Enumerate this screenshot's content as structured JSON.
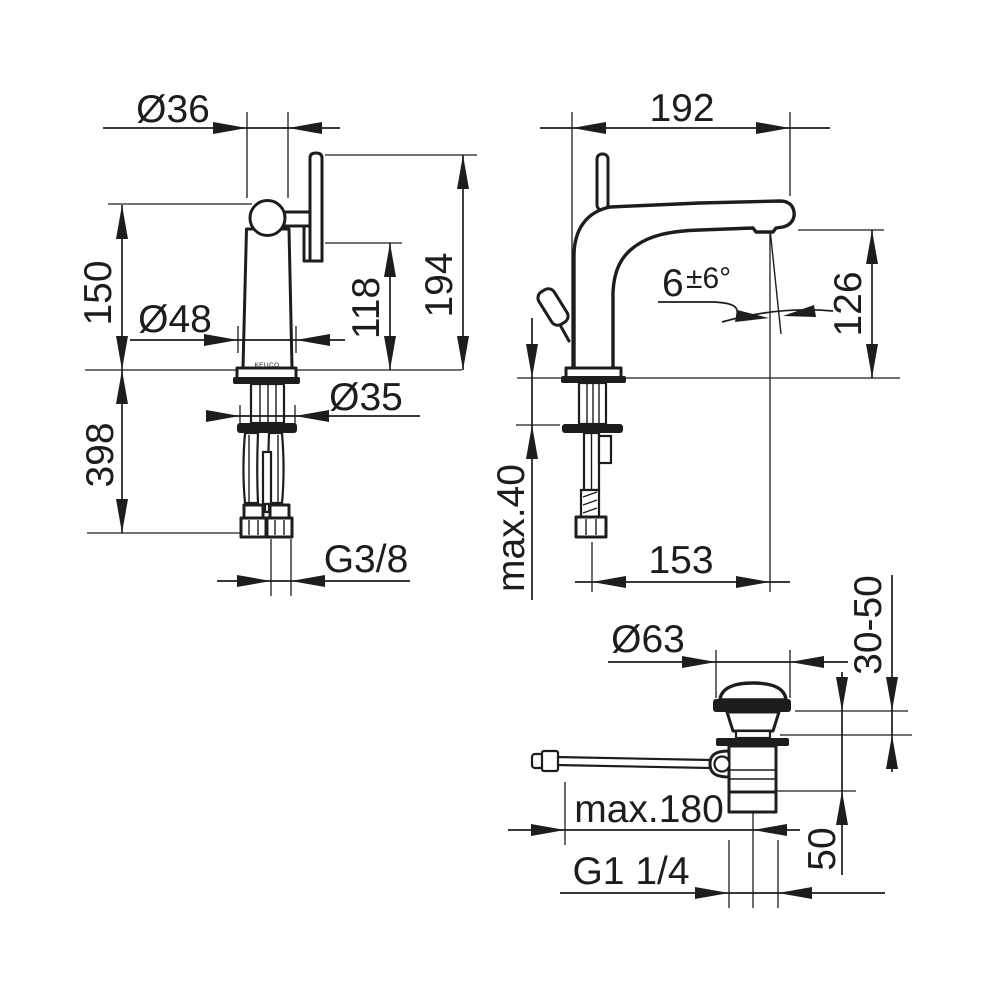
{
  "drawing": {
    "background": "#ffffff",
    "line_color": "#1d1d1d",
    "front_view": {
      "logo": "KEUCO",
      "dims": {
        "spout_diameter": "Ø36",
        "height_to_base": "150",
        "base_diameter": "Ø48",
        "handle_height": "118",
        "total_height": "194",
        "depth_below": "398",
        "shank_diameter": "Ø35",
        "supply_thread": "G3/8"
      }
    },
    "side_view": {
      "dims": {
        "spout_reach": "192",
        "angle_base": "6",
        "angle_tolerance": "±6°",
        "outlet_height": "126",
        "max_counter_thickness": "max.40",
        "outlet_projection": "153"
      }
    },
    "drain_view": {
      "dims": {
        "cap_diameter": "Ø63",
        "clamping_range": "30-50",
        "rod_length": "max.180",
        "body_depth": "50",
        "waste_thread": "G1 1/4"
      }
    }
  }
}
